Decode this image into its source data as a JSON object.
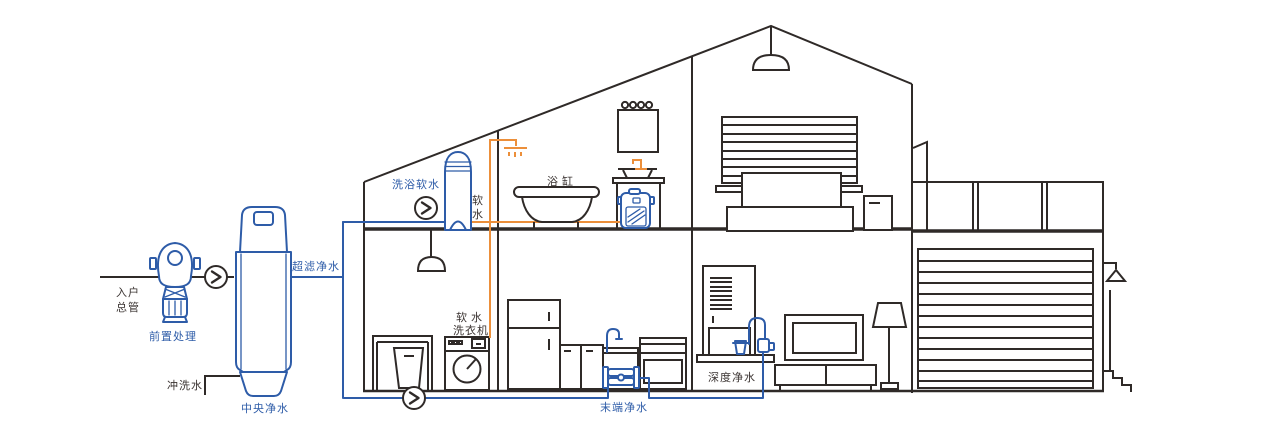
{
  "diagram_labels": {
    "inlet_main_line1": "入户",
    "inlet_main_line2": "总管",
    "pre_treatment": "前置处理",
    "flush_water": "冲洗水",
    "central_purification": "中央净水",
    "ultrafiltration": "超滤净水",
    "bath_softening": "洗浴软水",
    "soft_water_char1": "软",
    "soft_water_char2": "水",
    "bathtub": "浴缸",
    "soft_water_washer_line1": "软水",
    "soft_water_washer_line2": "洗衣机",
    "terminal_purification": "末端净水",
    "deep_purification": "深度净水"
  },
  "icons": {
    "flow_arrow": "right-chevron-in-circle"
  },
  "colors": {
    "outline": "#2f2a28",
    "purified_water_blue": "#2e5ca8",
    "soft_water_orange": "#ec8f3a",
    "background": "#ffffff"
  }
}
